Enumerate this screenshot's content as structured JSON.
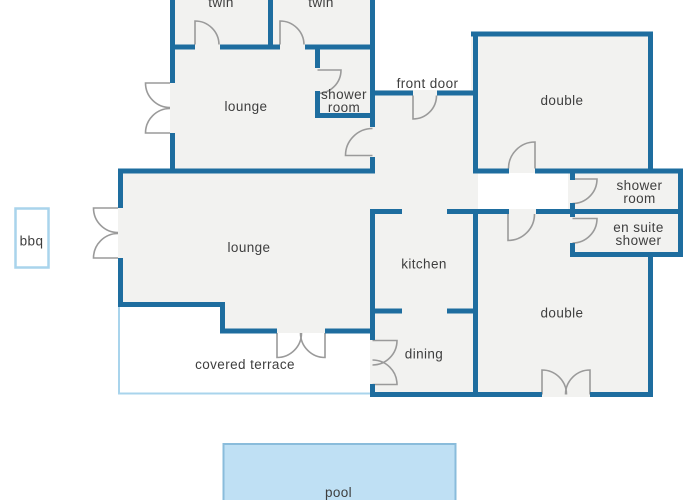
{
  "rooms": {
    "twin_1": "twin",
    "twin_2": "twin",
    "lounge_upper": "lounge",
    "shower_room_top": {
      "line1": "shower",
      "line2": "room"
    },
    "double_top": "double",
    "shower_room_right": {
      "line1": "shower",
      "line2": "room"
    },
    "en_suite_shower": {
      "line1": "en suite",
      "line2": "shower"
    },
    "lounge_main": "lounge",
    "kitchen": "kitchen",
    "double_bottom": "double",
    "dining": "dining",
    "covered_terrace": "covered terrace"
  },
  "outdoor": {
    "bbq": "bbq",
    "pool": "pool"
  },
  "annotations": {
    "front_door": "front door"
  },
  "colors": {
    "wall": "#1e6d9f",
    "door_swing": "#9a9a9a",
    "room_fill": "#f2f2f0",
    "light_outline": "#a9d4ec",
    "pool_fill": "#bfe0f4",
    "pool_border": "#8abcdb",
    "text": "#3e3e3e",
    "background": "#ffffff"
  }
}
